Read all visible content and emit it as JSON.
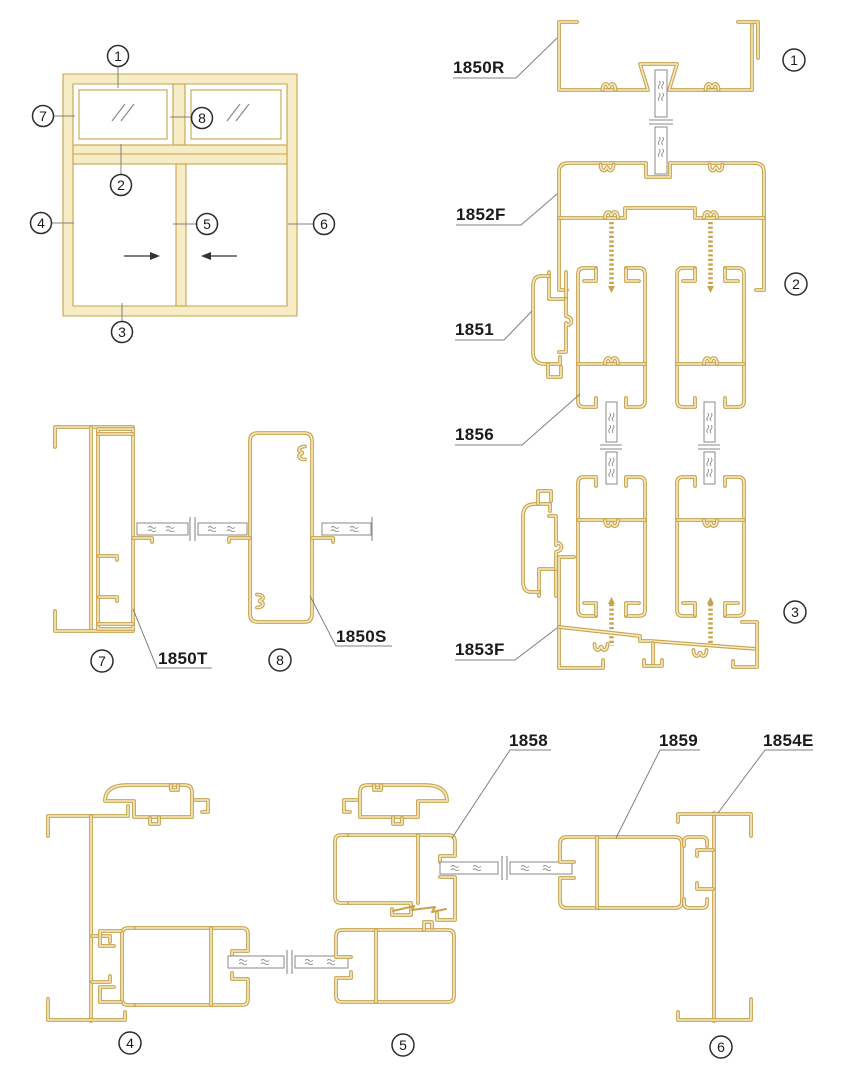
{
  "colors": {
    "profile_outline": "#C8A24C",
    "profile_fill": "#F6ECC5",
    "glass_line": "#8A8A8A",
    "leader_line": "#808080",
    "marker_ring": "#2B2B2B",
    "label_text": "#1A1A1A",
    "background": "#FFFFFF"
  },
  "part_labels": {
    "p1850R": "1850R",
    "p1852F": "1852F",
    "p1851": "1851",
    "p1856": "1856",
    "p1853F": "1853F",
    "p1850T": "1850T",
    "p1850S": "1850S",
    "p1858": "1858",
    "p1859": "1859",
    "p1854E": "1854E"
  },
  "markers": {
    "m1": "1",
    "m2": "2",
    "m3": "3",
    "m4": "4",
    "m5": "5",
    "m6": "6",
    "m7": "7",
    "m8": "8"
  }
}
